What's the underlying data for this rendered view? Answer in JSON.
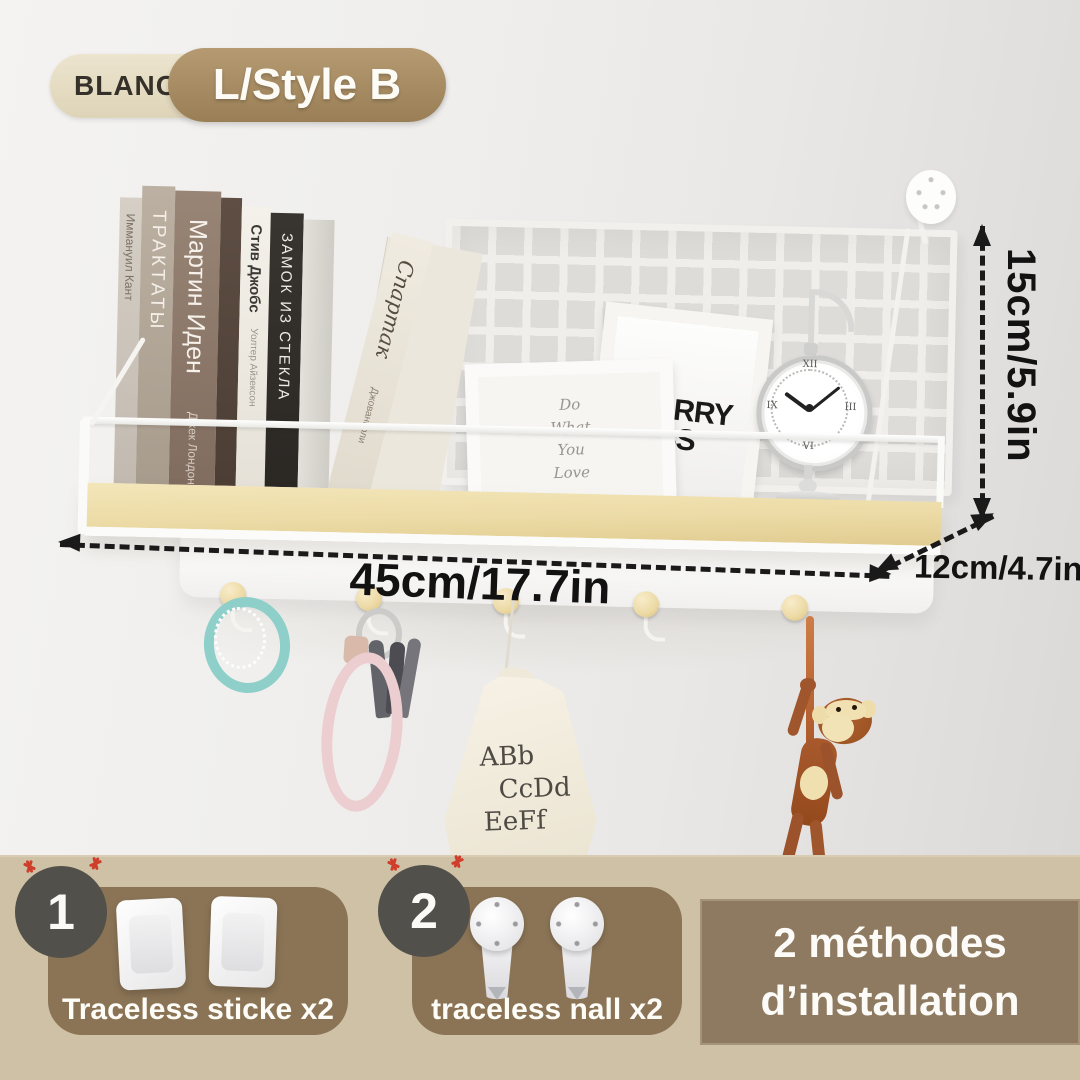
{
  "badge": {
    "color_label": "BLANC",
    "size_label": "L/Style B"
  },
  "dimensions": {
    "height": "15cm/5.9in",
    "width": "45cm/17.7in",
    "depth": "12cm/4.7in"
  },
  "shelf": {
    "books": [
      {
        "title": "Иммануил Кант"
      },
      {
        "title": "ТРАКТАТЫ"
      },
      {
        "title": "Мартин Иден",
        "author": "Джек Лондон"
      },
      {
        "title": ""
      },
      {
        "title": "Стив Джобс",
        "author": "Уолтер Айзексон"
      },
      {
        "title": "ЗАМОК ИЗ СТЕКЛА"
      },
      {
        "title": ""
      },
      {
        "title": "Спартак",
        "author": "Джованьоли"
      }
    ],
    "frame_quote_lines": [
      "Do",
      "What",
      "You",
      "Love"
    ],
    "frame_poster_lines": [
      "WORRY",
      "LESS"
    ],
    "clock_numerals": {
      "n12": "XII",
      "n3": "III",
      "n6": "VI",
      "n9": "IX"
    }
  },
  "hanging": {
    "bag_lines": [
      "ABb",
      "CcDd",
      "EeFf"
    ]
  },
  "installation": {
    "method1": {
      "number": "1",
      "label": "Traceless sticke x2"
    },
    "method2": {
      "number": "2",
      "label": "traceless nall x2"
    },
    "note_line1": "2 méthodes",
    "note_line2": "d’installation"
  },
  "colors": {
    "badge_beige": "#e6ddc5",
    "badge_brown": "#a78d66",
    "band": "#cfc1a5",
    "card_brown": "#8b7456",
    "note_brown": "#8e7a60",
    "circle_dark": "#52504a",
    "wood": "#ecdba6",
    "annotation_black": "#1a1a1a",
    "spark_red": "#cf3e2a"
  }
}
